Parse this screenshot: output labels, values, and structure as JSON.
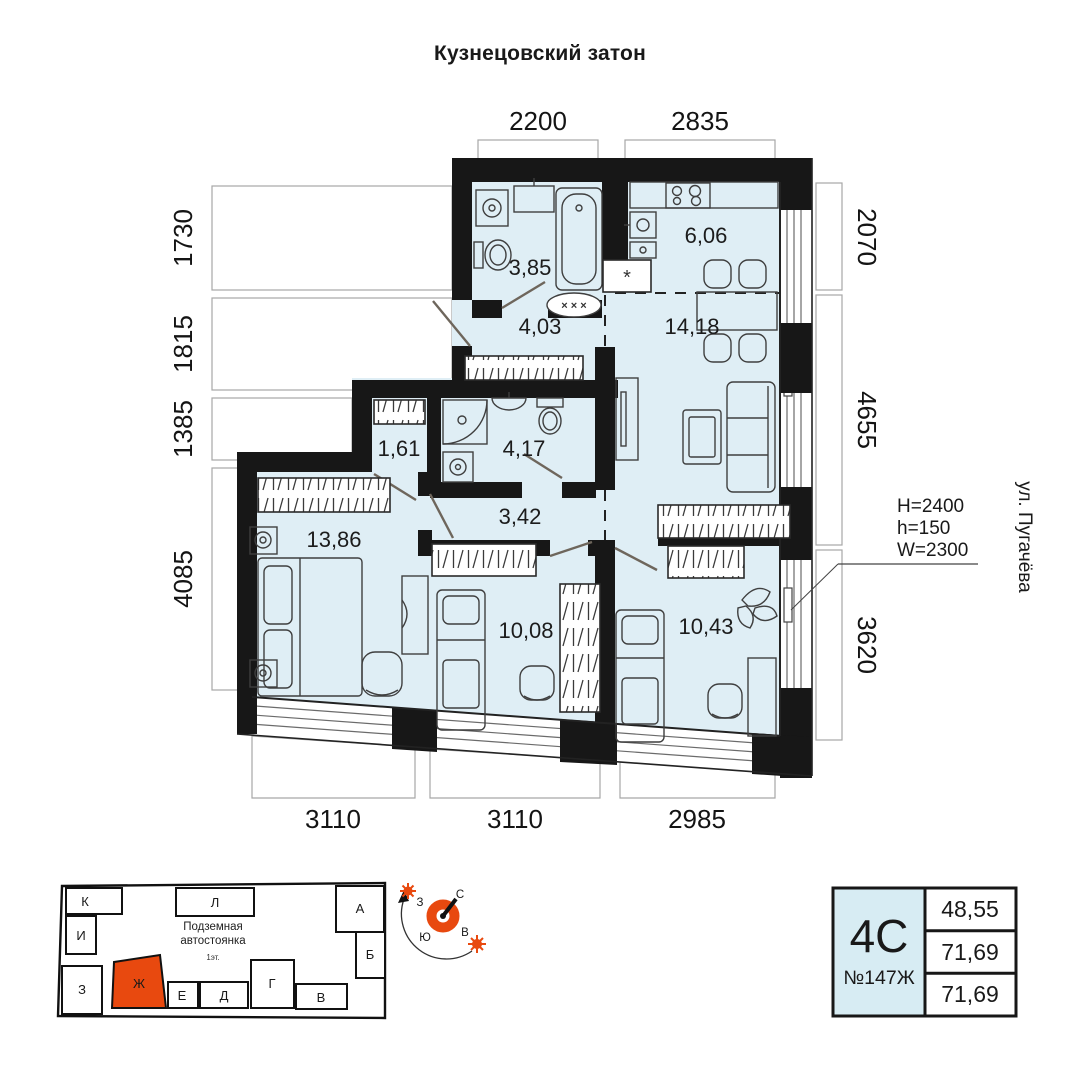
{
  "title": "Кузнецовский затон",
  "street_label": "ул. Пугачёва",
  "window_spec": {
    "height": "H=2400",
    "sill": "h=150",
    "width": "W=2300"
  },
  "dimensions": {
    "top": [
      "2200",
      "2835"
    ],
    "left": [
      "1730",
      "1815",
      "1385",
      "4085"
    ],
    "right": [
      "2070",
      "4655",
      "3620"
    ],
    "bottom": [
      "3110",
      "3110",
      "2985"
    ]
  },
  "rooms": [
    {
      "name": "bathroom-combined",
      "area": "3,85"
    },
    {
      "name": "kitchen",
      "area": "6,06"
    },
    {
      "name": "entry-hall",
      "area": "4,03"
    },
    {
      "name": "living-dining",
      "area": "14,18"
    },
    {
      "name": "closet",
      "area": "1,61"
    },
    {
      "name": "bathroom-2",
      "area": "4,17"
    },
    {
      "name": "inner-hall",
      "area": "3,42"
    },
    {
      "name": "bedroom-1",
      "area": "13,86"
    },
    {
      "name": "bedroom-2",
      "area": "10,08"
    },
    {
      "name": "bedroom-3",
      "area": "10,43"
    }
  ],
  "plan_symbols": {
    "fridge_niche": "*",
    "threshold": "× × ×"
  },
  "compass": {
    "north": "С",
    "south": "Ю",
    "west": "З",
    "east": "В"
  },
  "building_map": {
    "garage_label_1": "Подземная",
    "garage_label_2": "автостоянка",
    "garage_label_3": "1эт.",
    "sections": [
      "К",
      "Л",
      "А",
      "И",
      "Б",
      "З",
      "Ж",
      "Е",
      "Д",
      "Г",
      "В"
    ],
    "highlighted_section": "Ж"
  },
  "info_card": {
    "plan_type": "4С",
    "apartment_number": "№147Ж",
    "areas": [
      "48,55",
      "71,69",
      "71,69"
    ]
  },
  "colors": {
    "accent_orange": "#e8490f",
    "room_fill": "#dfeef5",
    "wall_black": "#171717",
    "card_fill": "#d7ecf3"
  }
}
